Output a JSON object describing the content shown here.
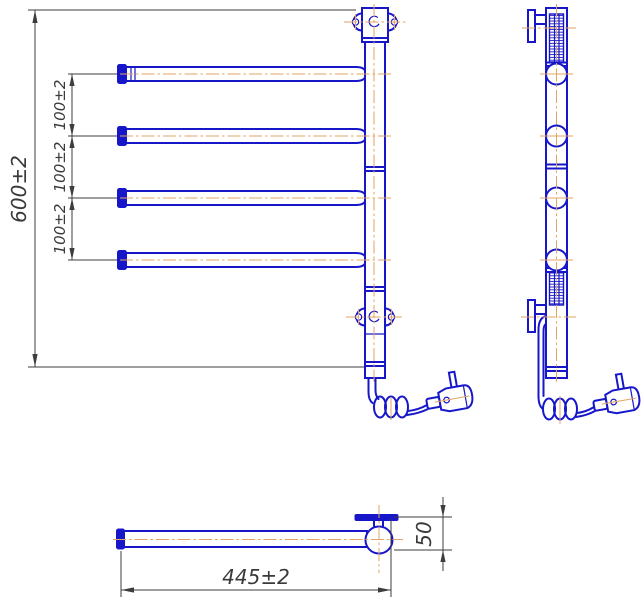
{
  "dims": {
    "overall_height": "600±2",
    "bar_spacing": [
      "100±2",
      "100±2",
      "100±2"
    ],
    "bar_length": "445±2",
    "wall_offset": "50"
  },
  "colors": {
    "line_blue": "#1717c9",
    "centerline_orange": "#e2a464",
    "dimension_gray": "#3d3d3d"
  }
}
